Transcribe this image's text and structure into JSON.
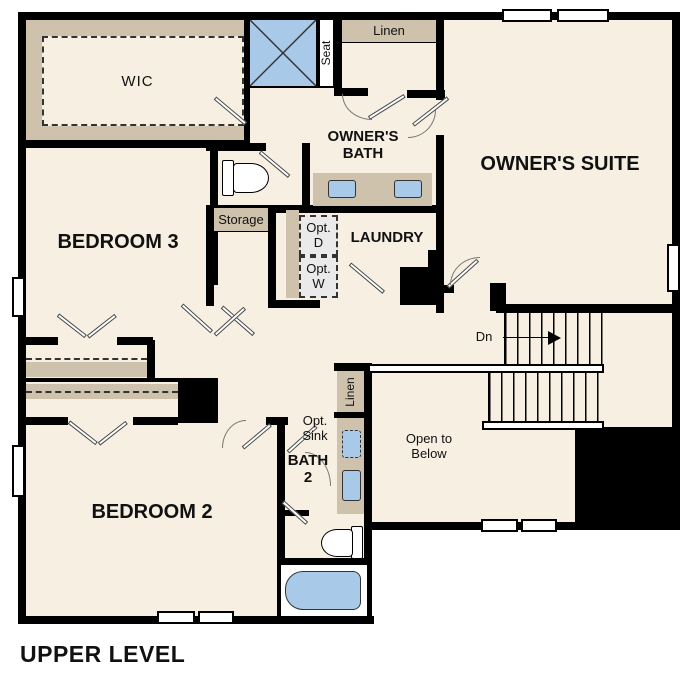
{
  "plan_title": "UPPER LEVEL",
  "rooms": {
    "wic": "WIC",
    "bedroom3": "BEDROOM 3",
    "bedroom2": "BEDROOM 2",
    "owners_suite": "OWNER'S SUITE",
    "owners_bath": "OWNER'S BATH",
    "laundry": "LAUNDRY",
    "bath2": "BATH 2"
  },
  "labels": {
    "linen_upper": "Linen",
    "linen_lower": "Linen",
    "seat": "Seat",
    "storage": "Storage",
    "opt_dryer": "Opt. D",
    "opt_washer": "Opt. W",
    "opt_sink": "Opt. Sink",
    "down": "Dn",
    "open_to_below": "Open to Below"
  },
  "colors": {
    "wall": "#000000",
    "floor": "#f6efe2",
    "casework_tan": "#cec2ac",
    "fixture_blue": "#a9c9e9",
    "appliance_gray": "#eaeaea",
    "background": "#ffffff"
  }
}
